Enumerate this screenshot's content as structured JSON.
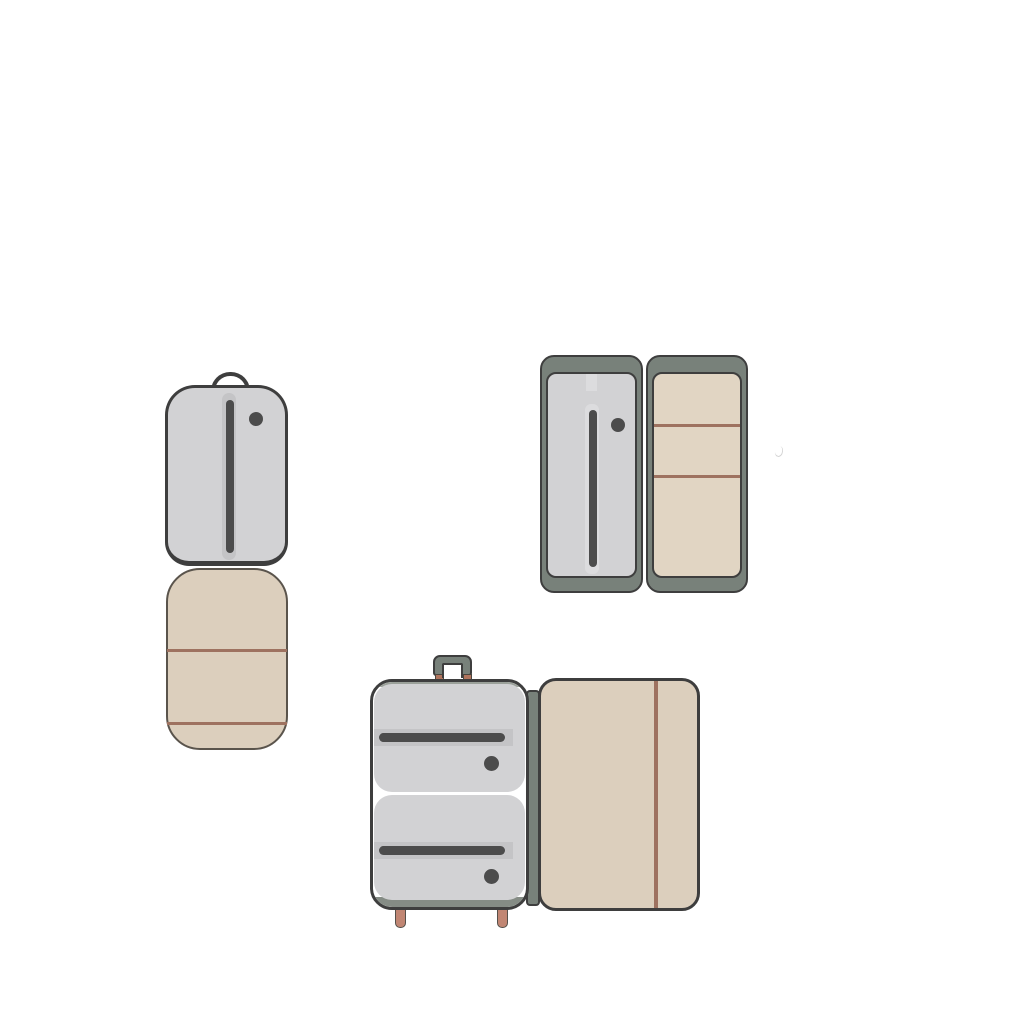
{
  "scene": {
    "background": "#ffffff",
    "description": "Flat vector illustrations of three pieces of opened soft luggage on a plain white background; no text labels anywhere",
    "items": [
      {
        "id": "garment-bag",
        "label": "Upright bag opened flat: gray zippered top shell with carry loop and zipper pull dot, beige lower flap with two horizontal stitched seams"
      },
      {
        "id": "book-opened-suitcase",
        "label": "Suitcase opened like a book: left gray zippered panel with pull dot, right beige lined panel with two stitched seams, both inside gray-green frames"
      },
      {
        "id": "rolling-suitcase",
        "label": "Upright suitcase opened sideways: gray half with two zippered compartments, top carry handle on copper posts, two feet; beige lined half with vertical stitched seam, joined by a gray-green spine"
      }
    ]
  },
  "colors": {
    "background": "#ffffff",
    "outline": "#3e3e3e",
    "shellGray": "#d2d2d4",
    "stripLight": "#dcdcde",
    "stripShade": "#c4c4c6",
    "zipDark": "#4c4c4c",
    "frameGreen": "#78817a",
    "bandGreenLight": "#9ba19a",
    "bandGreenDark": "#858c85",
    "beige": "#dccfbd",
    "beigeLight": "#e1d5c3",
    "beigeOutline": "#5a544c",
    "lineBrown": "#9e7260",
    "copper": "#b0745d",
    "footSalmon": "#c18673",
    "strayGray": "#c9c9c9"
  },
  "icons": [
    {
      "name": "carry-loop-icon",
      "depicts": "curved carry loop on top of garment bag"
    },
    {
      "name": "zipper-track-icon",
      "depicts": "dark zipper track bar"
    },
    {
      "name": "zipper-pull-dot-icon",
      "depicts": "round zipper pull"
    },
    {
      "name": "suitcase-handle-icon",
      "depicts": "squared carry handle"
    },
    {
      "name": "case-foot-icon",
      "depicts": "small salmon foot under suitcase"
    }
  ]
}
